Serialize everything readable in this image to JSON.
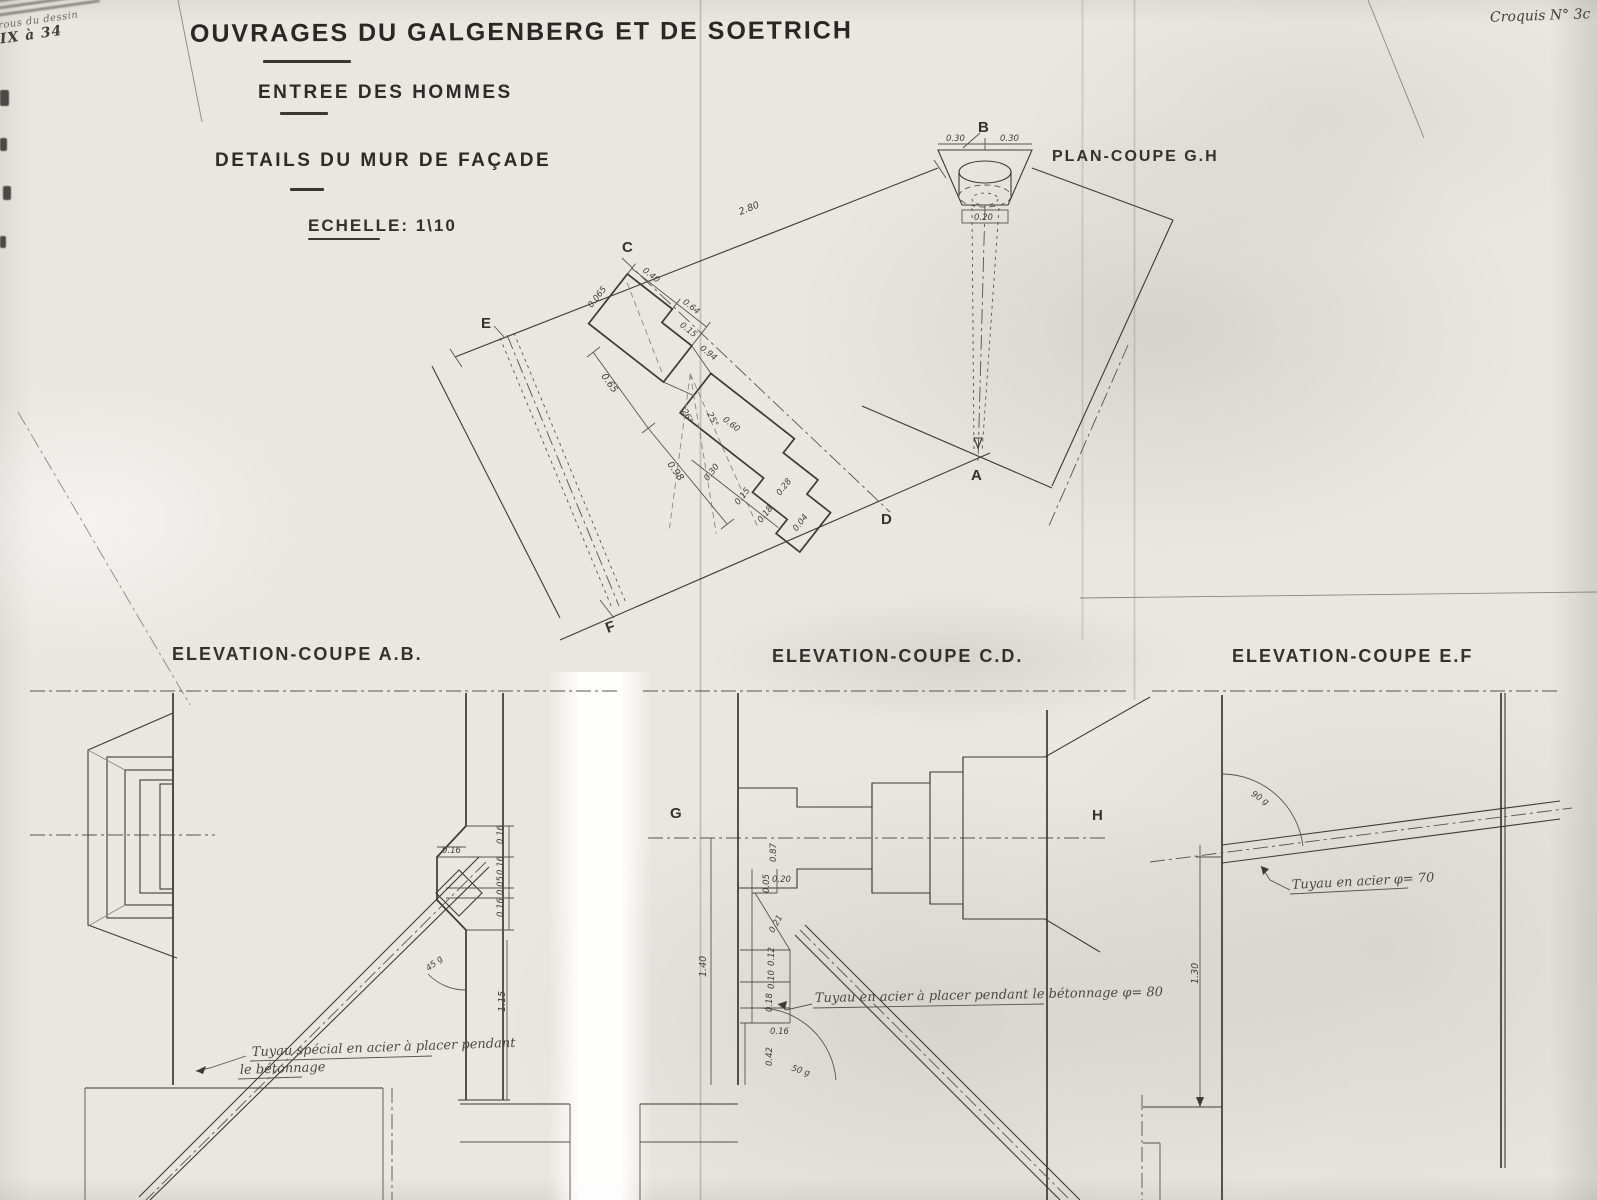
{
  "page": {
    "title": "OUVRAGES DU GALGENBERG ET DE SOETRICH",
    "subtitle": "ENTREE DES HOMMES",
    "subtitle2": "DETAILS DU MUR DE FAÇADE",
    "scale_label": "ECHELLE: 1\\10",
    "croquis_note": "Croquis N° 3c",
    "stamp_line1": "rous du dessin",
    "stamp_line2": "IX à 34"
  },
  "plan": {
    "title": "PLAN-COUPE G.H",
    "letters": {
      "b": "B",
      "c": "C",
      "e": "E",
      "a": "A",
      "d": "D",
      "f": "F"
    },
    "dims": {
      "span": "2.80",
      "vent_left": "0.30",
      "vent_right": "0.30",
      "vent_width": "0.20",
      "head_a": "0.40",
      "head_b": "0.64",
      "head_c": "0.15",
      "head_d": "0.065",
      "throat": "0.94",
      "angle_a": "26°",
      "angle_b": "25°",
      "side_a": "0.65",
      "side_b": "0.98",
      "step_a": "0.60",
      "step_b": "0.28",
      "step_c": "0.04",
      "edge_a": "0.30",
      "edge_b": "0.15",
      "edge_c": "0.18"
    }
  },
  "elevation_ab": {
    "title": "ELEVATION-COUPE A.B.",
    "dims": {
      "notch_top": "0.16",
      "r1": "0.16",
      "r2": "0.16",
      "r3": "0.05",
      "r4": "0.16",
      "height": "1.15",
      "angle": "45 g"
    },
    "note_line1": "Tuyau spécial en acier à placer pendant",
    "note_line2": "le bétonnage"
  },
  "elevation_cd": {
    "title": "ELEVATION-COUPE C.D.",
    "letters": {
      "g": "G",
      "h": "H"
    },
    "dims": {
      "d1": "0.87",
      "d2": "0.20",
      "d3": "0.05",
      "d4": "0.21",
      "d5": "0.12",
      "d6": "0.10",
      "d7": "0.18",
      "d8": "0.16",
      "d9": "0.42",
      "height": "1.40",
      "angle": "50 g"
    },
    "note": "Tuyau en acier à placer pendant le bétonnage  φ= 80"
  },
  "elevation_ef": {
    "title": "ELEVATION-COUPE E.F",
    "dims": {
      "height": "1.30",
      "angle": "90 g"
    },
    "note": "Tuyau en acier  φ= 70"
  }
}
